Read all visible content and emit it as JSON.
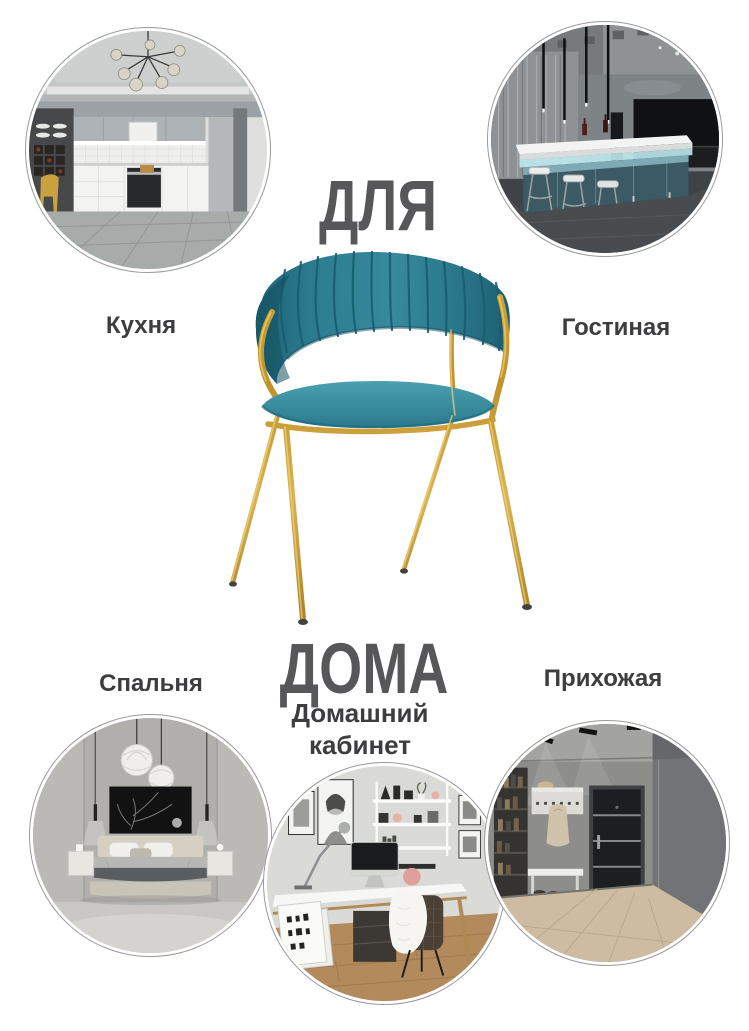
{
  "colors": {
    "background": "#ffffff",
    "title_text": "#57575a",
    "label_text": "#3d3d3f",
    "circle_border": "#9a9a9a",
    "chair_velvet": "#2e8296",
    "chair_seat": "#3b94a5",
    "chair_gold": "#c79b31"
  },
  "title": {
    "top": "ДЛЯ",
    "bottom": "ДОМА"
  },
  "rooms": [
    {
      "id": "kitchen",
      "label": "Кухня",
      "position": "top-left"
    },
    {
      "id": "living-room",
      "label": "Гостиная",
      "position": "top-right"
    },
    {
      "id": "bedroom",
      "label": "Спальня",
      "position": "bottom-left"
    },
    {
      "id": "home-office",
      "label": "Домашний кабинет",
      "position": "bottom-center"
    },
    {
      "id": "hallway",
      "label": "Прихожая",
      "position": "bottom-right"
    }
  ],
  "product": {
    "kind": "chair-photo",
    "upholstery": "teal velvet",
    "frame": "gold metal"
  }
}
